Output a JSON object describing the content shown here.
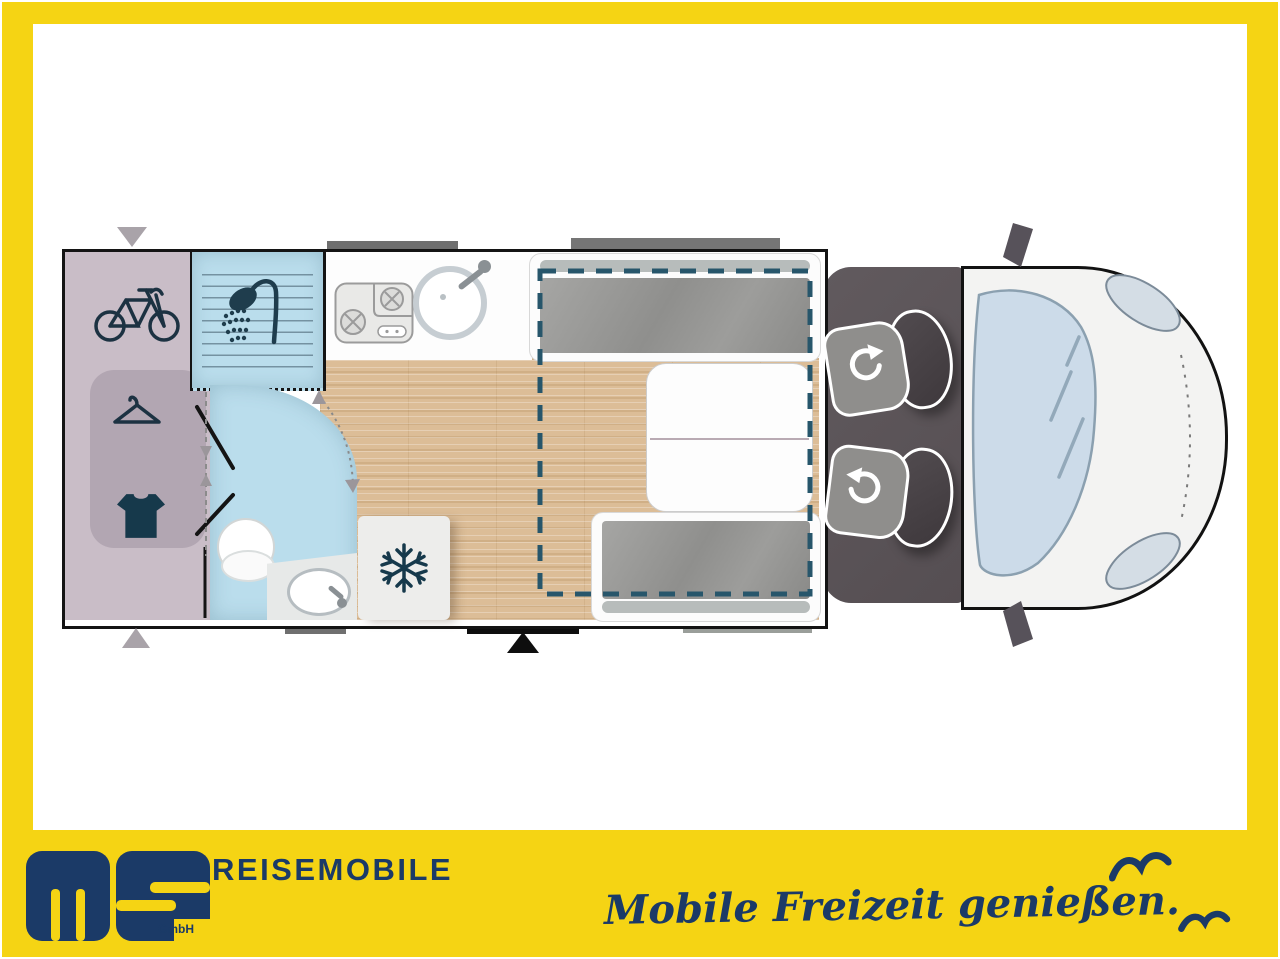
{
  "footer": {
    "logo": {
      "letters": "ms",
      "sub": "GmbH"
    },
    "brand": "REISEMOBILE",
    "slogan": "Mobile Freizeit genießen."
  },
  "colors": {
    "frame": "#F5D414",
    "navy": "#1B3A67",
    "wall": "#141414",
    "garage": "#C9BDC7",
    "garage_inner": "#B2A6B2",
    "wet_room": "#BADDEC",
    "wood": "#DCBD97",
    "counter": "#FDFDFD",
    "cushion": "#9B9B99",
    "cab": "#5B5357",
    "seat": "#8F8E8C",
    "seat_back": "#484246",
    "bed_dash": "#27566B",
    "vent": "#6F6F6F",
    "step": "#9A9E9A",
    "entry": "#0E0E0E",
    "arrow_gray": "#A9A3A9",
    "van_body": "#F3F3F2",
    "glass": "#CCDBE9",
    "fridge": "#EDEDEB",
    "icon_dark": "#16394B"
  },
  "floorplan": {
    "areas": [
      "rear-garage",
      "shower",
      "bathroom",
      "kitchen",
      "fridge",
      "dinette-bench-front",
      "dinette-bench-rear",
      "table",
      "drop-down-bed-outline",
      "cab",
      "entry-door"
    ],
    "icons": [
      "bicycle-icon",
      "hanger-icon",
      "tshirt-icon",
      "shower-icon",
      "snowflake-icon",
      "toilet-icon",
      "sink-icon",
      "stove-icon",
      "swivel-arrow-icon",
      "bird-icon"
    ]
  }
}
